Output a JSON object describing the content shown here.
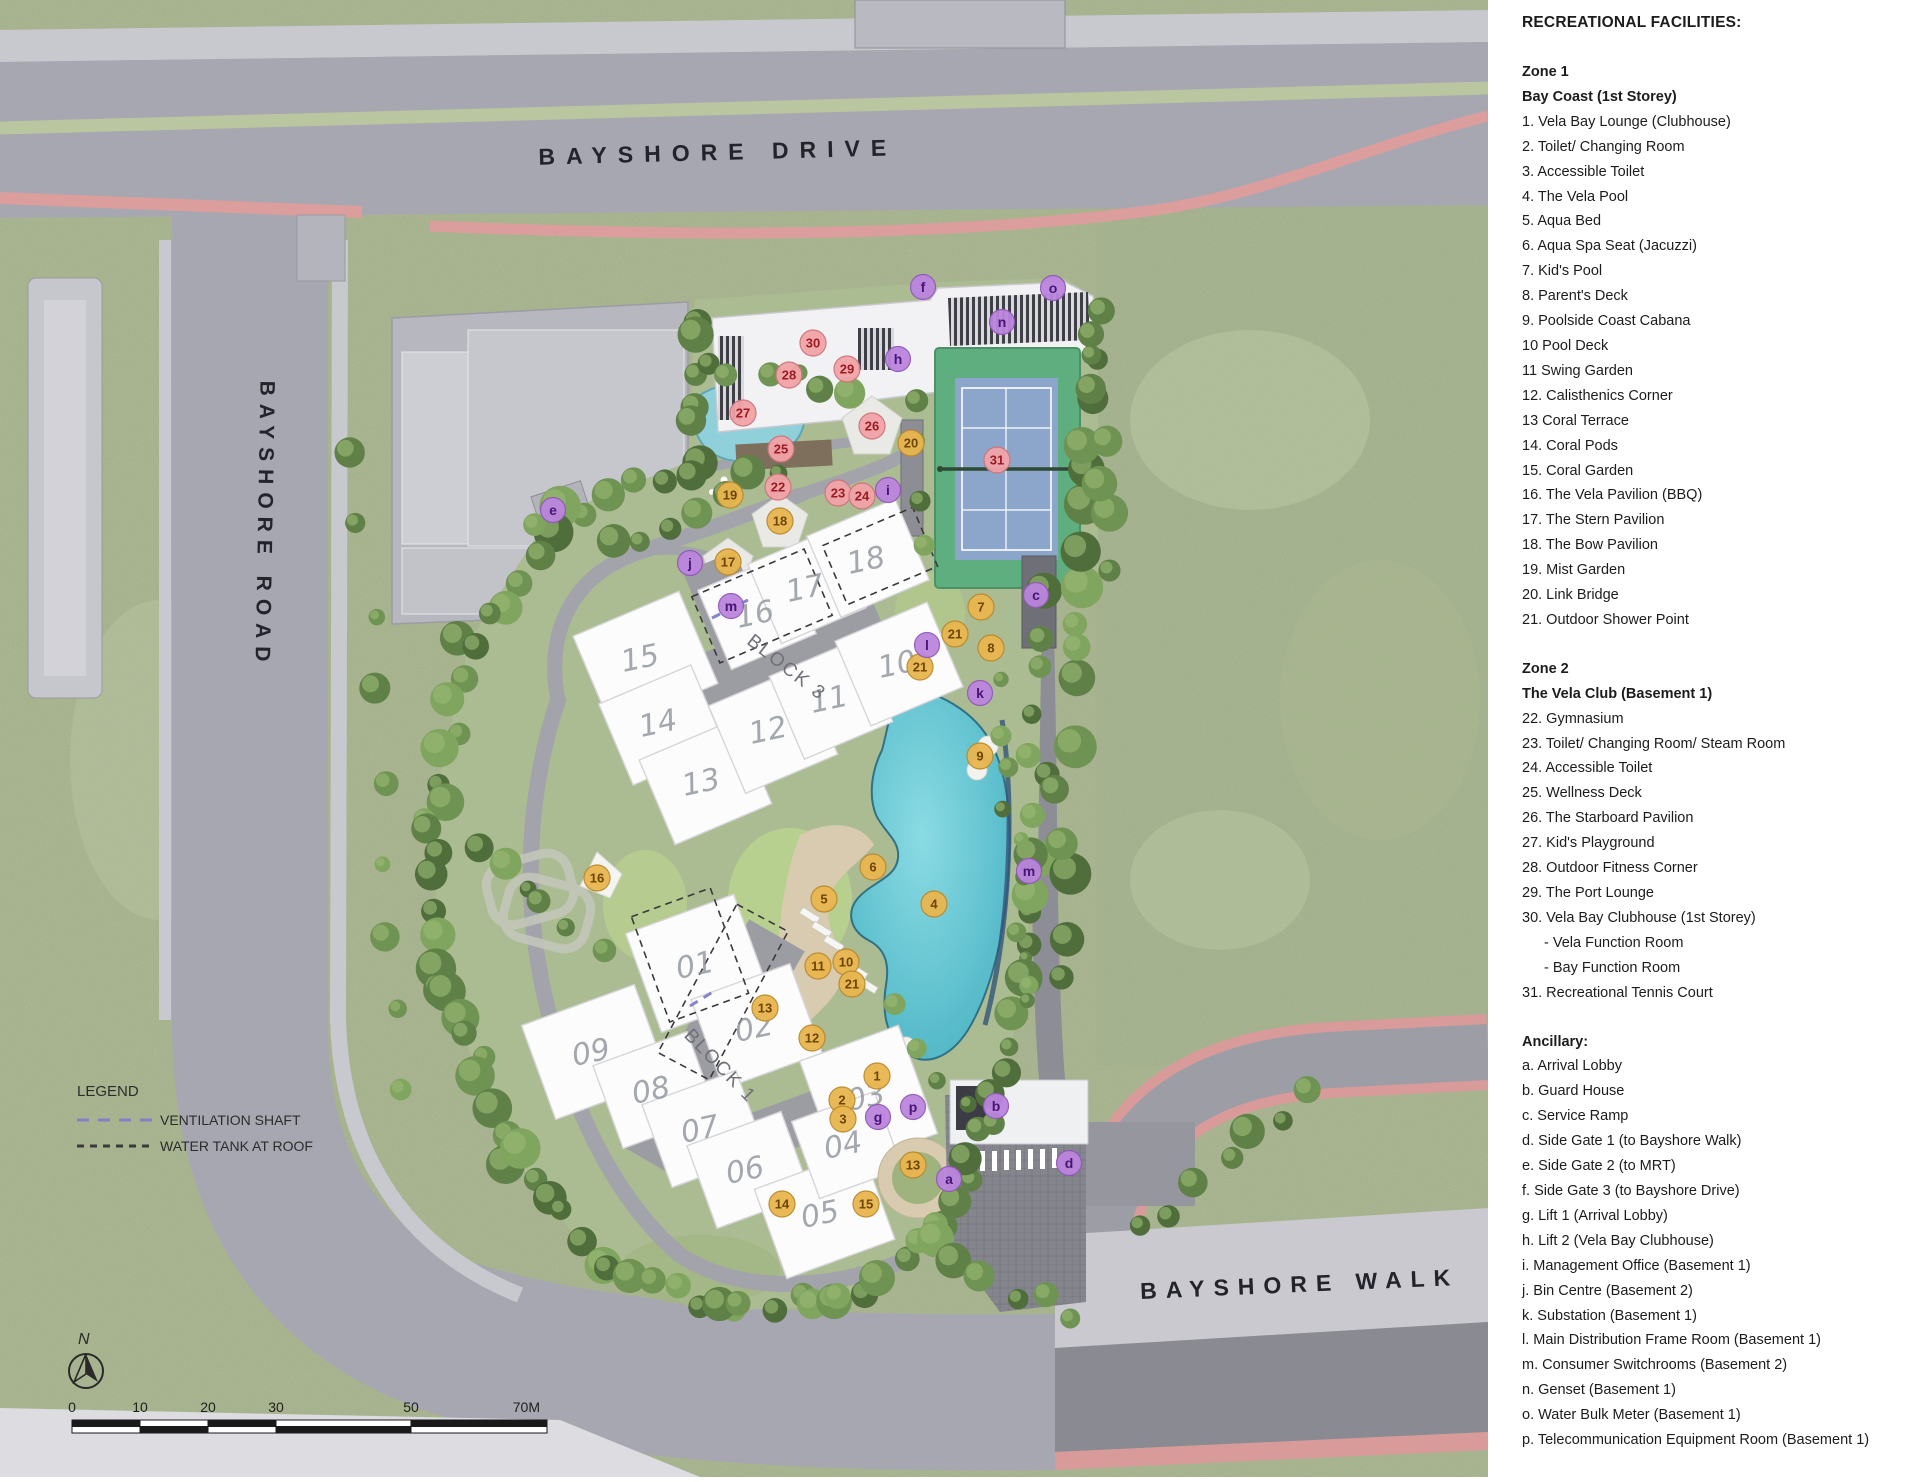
{
  "map": {
    "road_labels": [
      {
        "text": "BAYSHORE DRIVE"
      },
      {
        "text": "BAYSHORE ROAD"
      },
      {
        "text": "BAYSHORE WALK"
      }
    ],
    "north_label": "N",
    "legend": {
      "title": "LEGEND",
      "items": [
        {
          "label": "VENTILATION SHAFT",
          "style": "purple-dash",
          "color": "#8181c9"
        },
        {
          "label": "WATER TANK AT ROOF",
          "style": "black-dash",
          "color": "#3a3a3a"
        }
      ]
    },
    "scale_bar": {
      "labels": [
        "0",
        "10",
        "20",
        "30",
        "50",
        "70M"
      ]
    },
    "block_labels": [
      {
        "label": "BLOCK 3",
        "x": 783,
        "y": 672,
        "rot": 38
      },
      {
        "label": "BLOCK 1",
        "x": 716,
        "y": 1070,
        "rot": 46
      }
    ],
    "unit_labels": [
      {
        "label": "15",
        "x": 642,
        "y": 668
      },
      {
        "label": "16",
        "x": 757,
        "y": 624
      },
      {
        "label": "17",
        "x": 807,
        "y": 598
      },
      {
        "label": "18",
        "x": 868,
        "y": 570
      },
      {
        "label": "14",
        "x": 660,
        "y": 733
      },
      {
        "label": "13",
        "x": 703,
        "y": 792
      },
      {
        "label": "12",
        "x": 770,
        "y": 740
      },
      {
        "label": "11",
        "x": 831,
        "y": 709
      },
      {
        "label": "10",
        "x": 899,
        "y": 674
      },
      {
        "label": "01",
        "x": 697,
        "y": 975
      },
      {
        "label": "02",
        "x": 756,
        "y": 1038
      },
      {
        "label": "09",
        "x": 593,
        "y": 1062
      },
      {
        "label": "08",
        "x": 653,
        "y": 1100
      },
      {
        "label": "07",
        "x": 702,
        "y": 1139
      },
      {
        "label": "06",
        "x": 747,
        "y": 1180
      },
      {
        "label": "05",
        "x": 822,
        "y": 1224
      },
      {
        "label": "03",
        "x": 868,
        "y": 1107
      },
      {
        "label": "04",
        "x": 845,
        "y": 1155
      }
    ],
    "marker_colors": {
      "zone1": {
        "fill": "#e9b64f",
        "stroke": "#b98a2e",
        "text": "#6e4503"
      },
      "zone2": {
        "fill": "#f2a3a8",
        "stroke": "#cc747b",
        "text": "#991b23"
      },
      "ancillary": {
        "fill": "#bb85de",
        "stroke": "#9159b8",
        "text": "#471677"
      }
    },
    "markers": {
      "zone1": [
        {
          "label": "1",
          "x": 877,
          "y": 1076
        },
        {
          "label": "2",
          "x": 842,
          "y": 1100
        },
        {
          "label": "3",
          "x": 843,
          "y": 1119
        },
        {
          "label": "4",
          "x": 934,
          "y": 904
        },
        {
          "label": "5",
          "x": 824,
          "y": 899
        },
        {
          "label": "6",
          "x": 873,
          "y": 867
        },
        {
          "label": "7",
          "x": 981,
          "y": 607
        },
        {
          "label": "8",
          "x": 991,
          "y": 648
        },
        {
          "label": "9",
          "x": 980,
          "y": 756
        },
        {
          "label": "10",
          "x": 846,
          "y": 962
        },
        {
          "label": "11",
          "x": 818,
          "y": 966
        },
        {
          "label": "12",
          "x": 812,
          "y": 1038
        },
        {
          "label": "13",
          "x": 765,
          "y": 1008
        },
        {
          "label": "13",
          "x": 913,
          "y": 1165
        },
        {
          "label": "14",
          "x": 782,
          "y": 1204
        },
        {
          "label": "15",
          "x": 866,
          "y": 1204
        },
        {
          "label": "16",
          "x": 597,
          "y": 878
        },
        {
          "label": "17",
          "x": 728,
          "y": 562
        },
        {
          "label": "18",
          "x": 780,
          "y": 521
        },
        {
          "label": "19",
          "x": 730,
          "y": 495
        },
        {
          "label": "20",
          "x": 911,
          "y": 443
        },
        {
          "label": "21",
          "x": 955,
          "y": 634
        },
        {
          "label": "21",
          "x": 920,
          "y": 667
        },
        {
          "label": "21",
          "x": 852,
          "y": 984
        }
      ],
      "zone2": [
        {
          "label": "22",
          "x": 778,
          "y": 487
        },
        {
          "label": "23",
          "x": 838,
          "y": 493
        },
        {
          "label": "24",
          "x": 862,
          "y": 496
        },
        {
          "label": "25",
          "x": 781,
          "y": 449
        },
        {
          "label": "26",
          "x": 872,
          "y": 426
        },
        {
          "label": "27",
          "x": 743,
          "y": 413
        },
        {
          "label": "28",
          "x": 789,
          "y": 375
        },
        {
          "label": "29",
          "x": 847,
          "y": 369
        },
        {
          "label": "30",
          "x": 813,
          "y": 343
        },
        {
          "label": "31",
          "x": 997,
          "y": 460
        }
      ],
      "ancillary": [
        {
          "label": "a",
          "x": 949,
          "y": 1179
        },
        {
          "label": "b",
          "x": 996,
          "y": 1106
        },
        {
          "label": "c",
          "x": 1036,
          "y": 595
        },
        {
          "label": "d",
          "x": 1069,
          "y": 1163
        },
        {
          "label": "e",
          "x": 553,
          "y": 510
        },
        {
          "label": "f",
          "x": 923,
          "y": 287
        },
        {
          "label": "g",
          "x": 878,
          "y": 1117
        },
        {
          "label": "h",
          "x": 898,
          "y": 359
        },
        {
          "label": "i",
          "x": 888,
          "y": 490
        },
        {
          "label": "j",
          "x": 690,
          "y": 563
        },
        {
          "label": "k",
          "x": 980,
          "y": 693
        },
        {
          "label": "l",
          "x": 927,
          "y": 645
        },
        {
          "label": "m",
          "x": 731,
          "y": 606
        },
        {
          "label": "m",
          "x": 1029,
          "y": 871
        },
        {
          "label": "n",
          "x": 1002,
          "y": 322
        },
        {
          "label": "o",
          "x": 1053,
          "y": 288
        },
        {
          "label": "p",
          "x": 913,
          "y": 1107
        }
      ]
    },
    "feature_colors": {
      "grass": "#b6c39c",
      "site_green": "#abbc92",
      "road": "#a7a7b1",
      "pool": "#5fc3d2",
      "tennis_surface": "#8ba6ca",
      "tennis_surround": "#5fae7f",
      "pink_stripe": "#dc9d9d",
      "building_white": "#fcfcfc"
    }
  },
  "facilities_panel": {
    "title": "RECREATIONAL FACILITIES:",
    "zone1": {
      "heading": "Zone 1",
      "subheading": "Bay Coast (1st Storey)",
      "items": [
        "1. Vela Bay Lounge (Clubhouse)",
        "2. Toilet/ Changing Room",
        "3. Accessible Toilet",
        "4. The Vela Pool",
        "5. Aqua Bed",
        "6. Aqua Spa Seat (Jacuzzi)",
        "7. Kid's Pool",
        "8. Parent's Deck",
        "9. Poolside Coast Cabana",
        "10 Pool Deck",
        "11 Swing Garden",
        "12. Calisthenics Corner",
        "13 Coral Terrace",
        "14. Coral Pods",
        "15. Coral Garden",
        "16. The Vela Pavilion (BBQ)",
        "17. The Stern Pavilion",
        "18. The Bow Pavilion",
        "19. Mist Garden",
        "20. Link Bridge",
        "21. Outdoor Shower Point"
      ]
    },
    "zone2": {
      "heading": "Zone 2",
      "subheading": "The Vela Club (Basement 1)",
      "items": [
        "22. Gymnasium",
        "23. Toilet/ Changing Room/ Steam Room",
        "24. Accessible Toilet",
        "25. Wellness Deck",
        "26. The Starboard Pavilion",
        "27. Kid's Playground",
        "28. Outdoor Fitness Corner",
        "29. The Port Lounge",
        "30. Vela Bay Clubhouse (1st Storey)",
        "- Vela Function Room",
        "- Bay Function Room",
        "31. Recreational Tennis Court"
      ]
    },
    "ancillary": {
      "heading": "Ancillary:",
      "items": [
        "a. Arrival Lobby",
        "b. Guard House",
        "c. Service Ramp",
        "d. Side Gate 1 (to Bayshore Walk)",
        "e. Side Gate 2 (to MRT)",
        "f. Side Gate 3 (to Bayshore Drive)",
        "g. Lift 1 (Arrival Lobby)",
        "h. Lift 2 (Vela Bay Clubhouse)",
        "i. Management Office (Basement 1)",
        "j. Bin Centre (Basement 2)",
        "k. Substation (Basement 1)",
        "l. Main Distribution Frame Room (Basement 1)",
        "m. Consumer Switchrooms (Basement 2)",
        "n. Genset (Basement 1)",
        "o. Water Bulk Meter (Basement 1)",
        "p. Telecommunication Equipment Room (Basement 1)"
      ]
    }
  }
}
